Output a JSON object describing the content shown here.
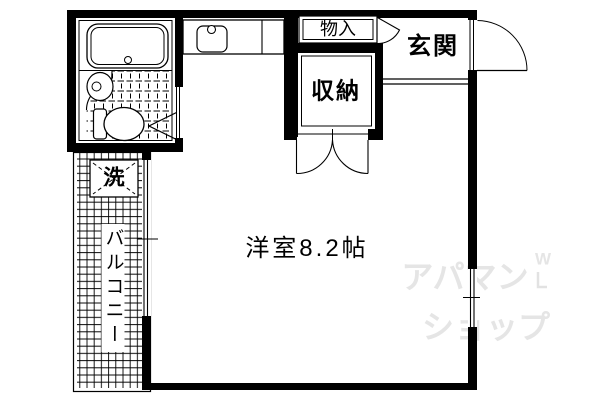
{
  "plan": {
    "rooms": {
      "main_room": {
        "label": "洋室8.2帖"
      },
      "entrance": {
        "label": "玄関"
      },
      "closet": {
        "label": "収納"
      },
      "storage": {
        "label": "物入"
      },
      "balcony": {
        "label": "バルコニー"
      },
      "washer": {
        "label": "洗"
      }
    },
    "fixtures": [
      "bathtub-icon",
      "toilet-icon",
      "wash-basin-icon",
      "kitchen-sink-icon",
      "washing-machine-icon",
      "closet-doors-icon",
      "entrance-door-icon",
      "bathroom-door-icon",
      "storage-door-icon",
      "window-icon"
    ],
    "colors": {
      "line": "#000000",
      "background": "#ffffff",
      "watermark": "#e5e5e5"
    }
  },
  "watermark": {
    "line1": "アパマン",
    "line2": "ショップ",
    "mark": "W"
  }
}
